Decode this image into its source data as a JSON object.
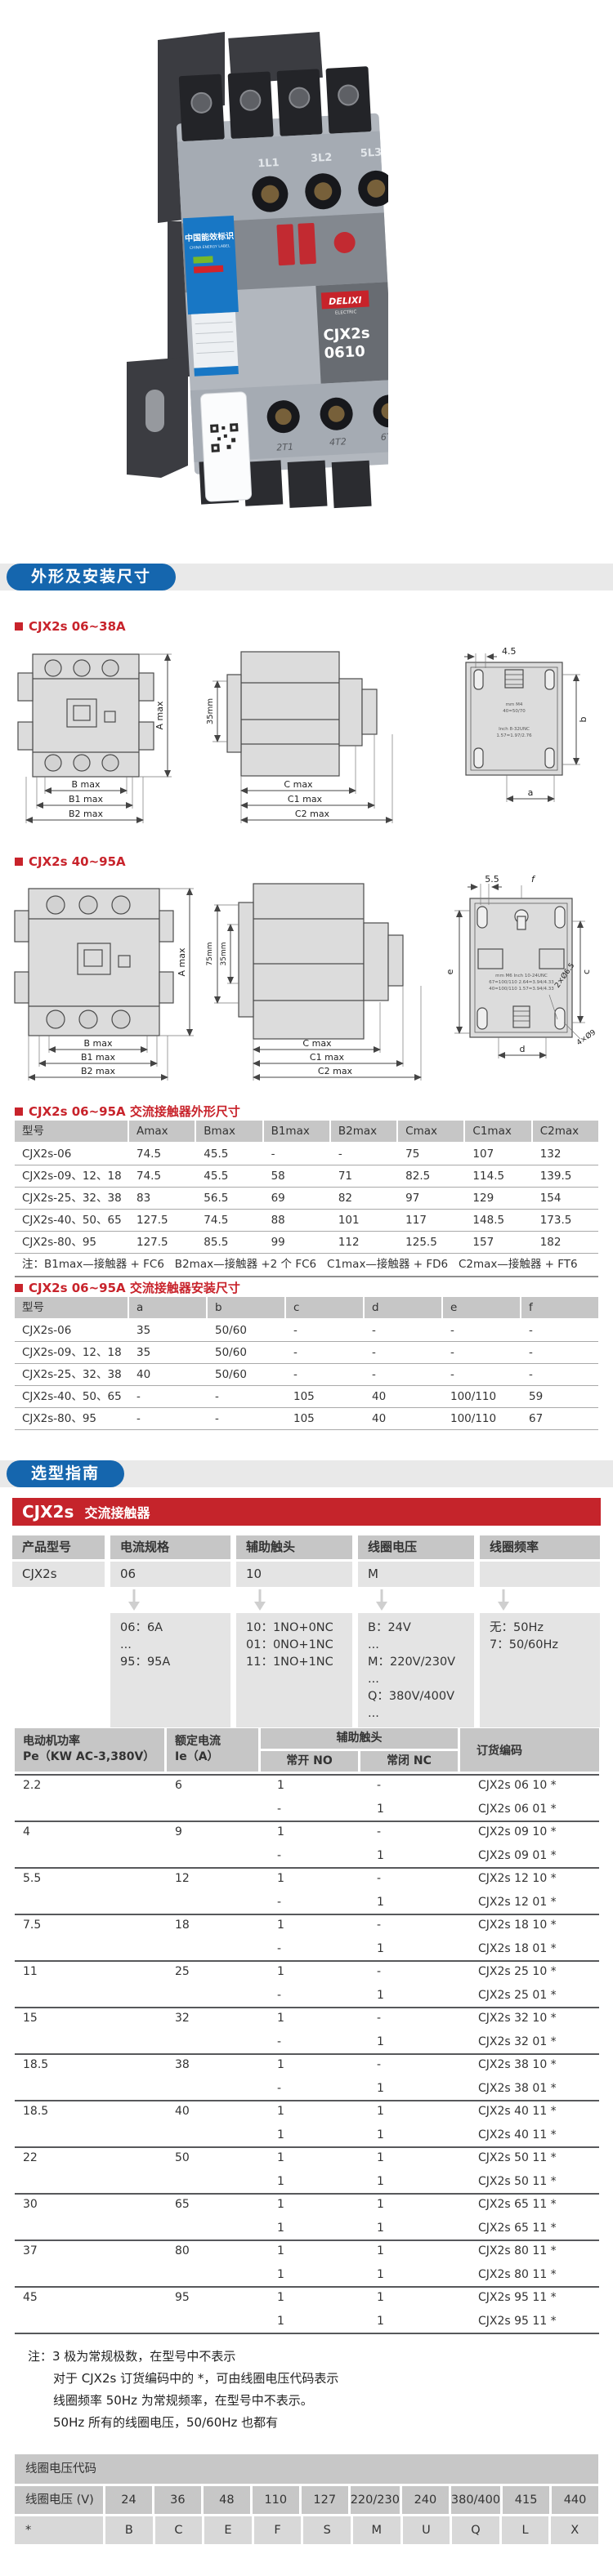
{
  "photo": {
    "brand": "DELIXI",
    "brand_sub": "ELECTRIC",
    "model_line1": "CJX2s",
    "model_line2": "0610",
    "energy_label": "中国能效标识",
    "energy_label_sub": "CHINA ENERGY LABEL",
    "terminals_top": [
      "1L1",
      "3L2",
      "5L3"
    ],
    "terminals_bottom": [
      "2T1",
      "4T2",
      "6T3"
    ]
  },
  "sections": {
    "dimensions_title": "外形及安装尺寸",
    "selection_title": "选型指南"
  },
  "drawing1": {
    "label": "CJX2s 06~38A",
    "dims": {
      "A": "A max",
      "B": "B max",
      "B1": "B1 max",
      "B2": "B2 max",
      "C": "C max",
      "C1": "C1 max",
      "C2": "C2 max",
      "rail": "35mm",
      "top": "4.5",
      "b": "b",
      "a": "a"
    },
    "plate": [
      "mm  M4",
      "40=50/70",
      "Inch  8-32UNC",
      "1.57=1.97/2.76"
    ]
  },
  "drawing2": {
    "label": "CJX2s 40~95A",
    "dims": {
      "A": "A max",
      "B": "B max",
      "B1": "B1 max",
      "B2": "B2 max",
      "C": "C max",
      "C1": "C1 max",
      "C2": "C2 max",
      "rail75": "75mm",
      "rail35": "35mm",
      "top": "5.5",
      "f": "f",
      "e": "e",
      "c": "c",
      "d": "d",
      "holes_small": "2×Ø6.5",
      "holes_big": "4×Ø9"
    },
    "plate": [
      "mm  M6   Inch 10-24UNC",
      "67=100/110  2.64=3.94/4.33",
      "40=100/110  1.57=3.94/4.33"
    ]
  },
  "outline_table": {
    "label": "CJX2s 06~95A 交流接触器外形尺寸",
    "headers": [
      "型号",
      "Amax",
      "Bmax",
      "B1max",
      "B2max",
      "Cmax",
      "C1max",
      "C2max"
    ],
    "rows": [
      [
        "CJX2s-06",
        "74.5",
        "45.5",
        "-",
        "-",
        "75",
        "107",
        "132"
      ],
      [
        "CJX2s-09、12、18",
        "74.5",
        "45.5",
        "58",
        "71",
        "82.5",
        "114.5",
        "139.5"
      ],
      [
        "CJX2s-25、32、38",
        "83",
        "56.5",
        "69",
        "82",
        "97",
        "129",
        "154"
      ],
      [
        "CJX2s-40、50、65",
        "127.5",
        "74.5",
        "88",
        "101",
        "117",
        "148.5",
        "173.5"
      ],
      [
        "CJX2s-80、95",
        "127.5",
        "85.5",
        "99",
        "112",
        "125.5",
        "157",
        "182"
      ]
    ],
    "note": "注：B1max—接触器 + FC6   B2max—接触器 +2 个 FC6   C1max—接触器 + FD6   C2max—接触器 + FT6"
  },
  "mounting_table": {
    "label": "CJX2s 06~95A 交流接触器安装尺寸",
    "headers": [
      "型号",
      "a",
      "b",
      "c",
      "d",
      "e",
      "f"
    ],
    "rows": [
      [
        "CJX2s-06",
        "35",
        "50/60",
        "-",
        "-",
        "-",
        "-"
      ],
      [
        "CJX2s-09、12、18",
        "35",
        "50/60",
        "-",
        "-",
        "-",
        "-"
      ],
      [
        "CJX2s-25、32、38",
        "40",
        "50/60",
        "-",
        "-",
        "-",
        "-"
      ],
      [
        "CJX2s-40、50、65",
        "-",
        "-",
        "105",
        "40",
        "100/110",
        "59"
      ],
      [
        "CJX2s-80、95",
        "-",
        "-",
        "105",
        "40",
        "100/110",
        "67"
      ]
    ]
  },
  "model_banner": {
    "model": "CJX2s",
    "suffix": "交流接触器"
  },
  "selection_table": {
    "headers": [
      "产品型号",
      "电流规格",
      "辅助触头",
      "线圈电压",
      "线圈频率"
    ],
    "values": [
      "CJX2s",
      "06",
      "10",
      "M",
      ""
    ],
    "details": [
      {
        "lines": []
      },
      {
        "lines": [
          "06：6A",
          "...",
          "95：95A"
        ]
      },
      {
        "lines": [
          "10：1NO+0NC",
          "01：0NO+1NC",
          "11：1NO+1NC"
        ]
      },
      {
        "lines": [
          "B：24V",
          "...",
          "M：220V/230V",
          "...",
          "Q：380V/400V",
          "..."
        ]
      },
      {
        "lines": [
          "无：50Hz",
          "7：50/60Hz"
        ]
      }
    ]
  },
  "order_table": {
    "header": {
      "col1a": "电动机功率",
      "col1b": "Pe（KW AC-3,380V）",
      "col2a": "额定电流",
      "col2b": "Ie（A）",
      "aux": "辅助触头",
      "no": "常开 NO",
      "nc": "常闭 NC",
      "code": "订货编码"
    },
    "rows": [
      {
        "pe": "2.2",
        "ie": "6",
        "no": "1",
        "nc": "-",
        "code": "CJX2s 06 10 *",
        "group": "start"
      },
      {
        "pe": "",
        "ie": "",
        "no": "-",
        "nc": "1",
        "code": "CJX2s 06 01 *",
        "group": ""
      },
      {
        "pe": "4",
        "ie": "9",
        "no": "1",
        "nc": "-",
        "code": "CJX2s 09 10 *",
        "group": "start"
      },
      {
        "pe": "",
        "ie": "",
        "no": "-",
        "nc": "1",
        "code": "CJX2s 09 01 *",
        "group": ""
      },
      {
        "pe": "5.5",
        "ie": "12",
        "no": "1",
        "nc": "-",
        "code": "CJX2s 12 10 *",
        "group": "start"
      },
      {
        "pe": "",
        "ie": "",
        "no": "-",
        "nc": "1",
        "code": "CJX2s 12 01 *",
        "group": ""
      },
      {
        "pe": "7.5",
        "ie": "18",
        "no": "1",
        "nc": "-",
        "code": "CJX2s 18 10 *",
        "group": "start"
      },
      {
        "pe": "",
        "ie": "",
        "no": "-",
        "nc": "1",
        "code": "CJX2s 18 01 *",
        "group": ""
      },
      {
        "pe": "11",
        "ie": "25",
        "no": "1",
        "nc": "-",
        "code": "CJX2s 25 10 *",
        "group": "start"
      },
      {
        "pe": "",
        "ie": "",
        "no": "-",
        "nc": "1",
        "code": "CJX2s 25 01 *",
        "group": ""
      },
      {
        "pe": "15",
        "ie": "32",
        "no": "1",
        "nc": "-",
        "code": "CJX2s 32 10 *",
        "group": "start"
      },
      {
        "pe": "",
        "ie": "",
        "no": "-",
        "nc": "1",
        "code": "CJX2s 32 01 *",
        "group": ""
      },
      {
        "pe": "18.5",
        "ie": "38",
        "no": "1",
        "nc": "-",
        "code": "CJX2s 38 10 *",
        "group": "start"
      },
      {
        "pe": "",
        "ie": "",
        "no": "-",
        "nc": "1",
        "code": "CJX2s 38 01 *",
        "group": ""
      },
      {
        "pe": "18.5",
        "ie": "40",
        "no": "1",
        "nc": "1",
        "code": "CJX2s 40 11 *",
        "group": "start"
      },
      {
        "pe": "",
        "ie": "",
        "no": "1",
        "nc": "1",
        "code": "CJX2s 40 11 *",
        "group": ""
      },
      {
        "pe": "22",
        "ie": "50",
        "no": "1",
        "nc": "1",
        "code": "CJX2s 50 11 *",
        "group": "start"
      },
      {
        "pe": "",
        "ie": "",
        "no": "1",
        "nc": "1",
        "code": "CJX2s 50 11 *",
        "group": ""
      },
      {
        "pe": "30",
        "ie": "65",
        "no": "1",
        "nc": "1",
        "code": "CJX2s 65 11 *",
        "group": "start"
      },
      {
        "pe": "",
        "ie": "",
        "no": "1",
        "nc": "1",
        "code": "CJX2s 65 11 *",
        "group": ""
      },
      {
        "pe": "37",
        "ie": "80",
        "no": "1",
        "nc": "1",
        "code": "CJX2s 80 11 *",
        "group": "start"
      },
      {
        "pe": "",
        "ie": "",
        "no": "1",
        "nc": "1",
        "code": "CJX2s 80 11 *",
        "group": ""
      },
      {
        "pe": "45",
        "ie": "95",
        "no": "1",
        "nc": "1",
        "code": "CJX2s 95 11 *",
        "group": "start"
      },
      {
        "pe": "",
        "ie": "",
        "no": "1",
        "nc": "1",
        "code": "CJX2s 95 11 *",
        "group": ""
      }
    ]
  },
  "notes": {
    "line1": "注：3 极为常规极数，在型号中不表示",
    "line2": "对于 CJX2s 订货编码中的 *，可由线圈电压代码表示",
    "line3": "线圈频率 50Hz 为常规频率，在型号中不表示。",
    "line4": "50Hz 所有的线圈电压，50/60Hz 也都有"
  },
  "coil_table": {
    "title": "线圈电压代码",
    "row1_label": "线圈电压 (V)",
    "row1": [
      "24",
      "36",
      "48",
      "110",
      "127",
      "220/230",
      "240",
      "380/400",
      "415",
      "440"
    ],
    "row2_label": "*",
    "row2": [
      "B",
      "C",
      "E",
      "F",
      "S",
      "M",
      "U",
      "Q",
      "L",
      "X"
    ]
  },
  "colors": {
    "accent_blue": "#1566ae",
    "accent_red": "#c5242b",
    "header_gray": "#c6c6c6"
  }
}
